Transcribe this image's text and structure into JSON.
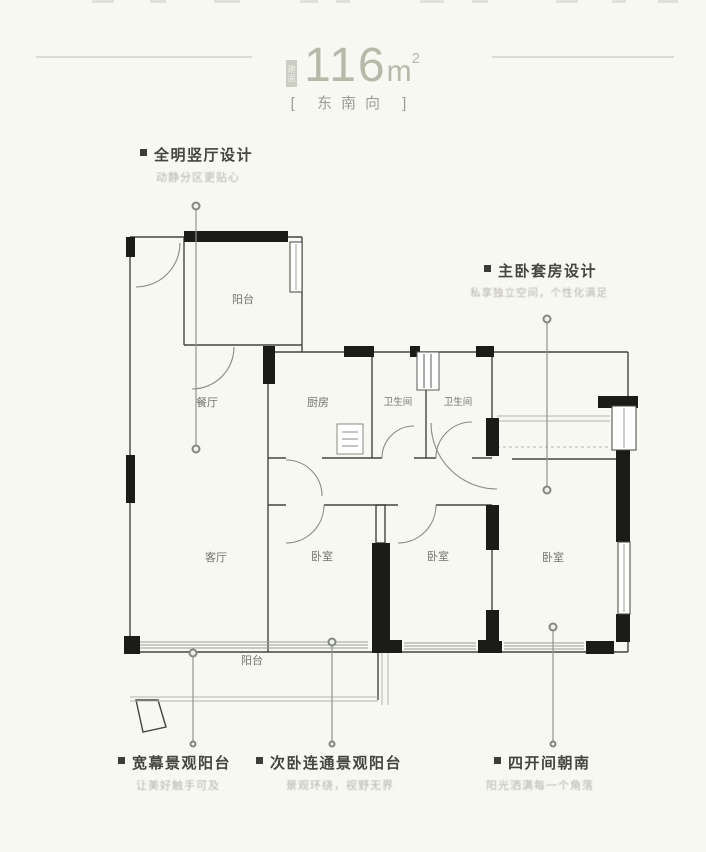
{
  "title": {
    "prefix": "建面",
    "area_value": "116",
    "area_unit": "m",
    "area_sup": "2"
  },
  "orientation": "[ 东南向 ]",
  "annotations": {
    "top_left": {
      "title": "全明竖厅设计",
      "subtitle": "动静分区更贴心"
    },
    "right": {
      "title": "主卧套房设计",
      "subtitle": "私享独立空间，个性化满足"
    },
    "bottom_left": {
      "title": "宽幕景观阳台",
      "subtitle": "让美好触手可及"
    },
    "bottom_center": {
      "title": "次卧连通景观阳台",
      "subtitle": "景观环绕，视野无界"
    },
    "bottom_right": {
      "title": "四开间朝南",
      "subtitle": "阳光洒满每一个角落"
    }
  },
  "rooms": {
    "balcony_top": "阳台",
    "dining": "餐厅",
    "kitchen": "厨房",
    "bath1": "卫生间",
    "bath2": "卫生间",
    "living": "客厅",
    "bedroom2": "卧室",
    "bedroom3": "卧室",
    "master": "卧室",
    "balcony_bottom": "阳台"
  },
  "colors": {
    "background": "#f8f8f3",
    "title_accent": "#b6b9a7",
    "rule_line": "#dbdbd1",
    "orientation_text": "#9c9c92",
    "annotation_title": "#454540",
    "annotation_subtitle": "#b5b5ac",
    "wall_line": "#45453f",
    "wall_black": "#1b1b17",
    "window_line": "#9d9d95",
    "door_arc": "#8a8a82",
    "leader_line": "#90948d",
    "room_label": "#75756d"
  }
}
